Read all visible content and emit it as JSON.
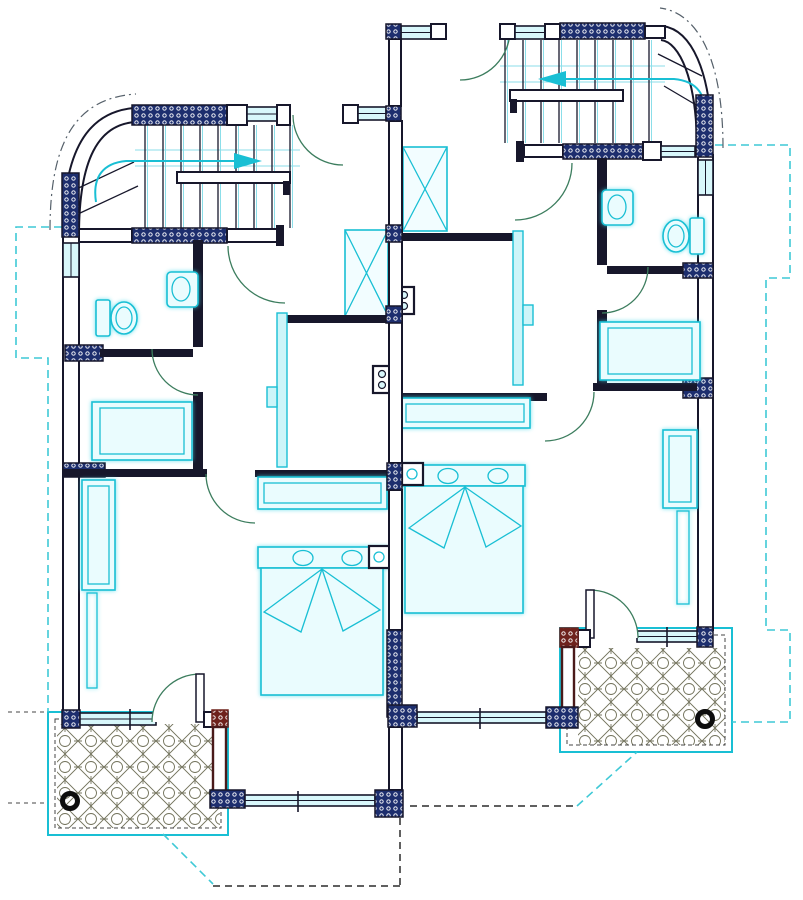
{
  "drawing": {
    "kind": "architectural-floor-plan",
    "style": "scanned CAD drawing, no text labels",
    "description": "Upper floor plan of a mirrored two-unit duplex. Each unit has a quarter-turn staircase behind a curved corner wall, a bathroom with toilet and wash basin, a middle room with dresser, a rear bedroom with double bed, nightstand and wardrobe, and a tiled patio with floor drain. Units share a central party wall with hatched masonry piers.",
    "units": [
      "left-unit",
      "right-unit"
    ],
    "right_unit_vertical_offset_px": -82
  },
  "colors": {
    "paper": "#ffffff",
    "wall": "#17172b",
    "pier_fill": "#1d2e6e",
    "pier_dot": "#ffffff",
    "pier_red": "#6e221c",
    "maroon": "#4a1a1a",
    "fixture": "#19bfd4",
    "fixture_fill": "#eafcfe",
    "window_fill": "#d8f7fb",
    "door_arc": "#3c7d5e",
    "dashed_teal": "#3fc9d6",
    "dashed_dark": "#2b2b2b",
    "dashed_gray": "#6a6a6a",
    "patio_hatch": "#73735c",
    "drain": "#0d0d0d",
    "slider_fill": "#cdf5f9",
    "shaft_fill": "#f2fdff"
  },
  "inventory": {
    "staircases": 2,
    "curved_corner_walls": 2,
    "hinged_doors": 10,
    "sliding_partitions": 2,
    "toilets": 2,
    "wash_basins": 2,
    "double_beds": 2,
    "bed_pillows": 4,
    "nightstands": 2,
    "wardrobes": 2,
    "desks_dressers": 4,
    "service_shafts_x_marked": 2,
    "wall_appliance_panels": 2,
    "patios": 2,
    "patio_floor_drains": 2,
    "window_openings": 11,
    "hatched_masonry_piers": 22,
    "red_masonry_piers": 2
  },
  "patio": {
    "hatch_motif": "diamond lattice with circles",
    "drain_symbol": "heavy black ring"
  },
  "annotations": {
    "visible_text_labels": []
  }
}
